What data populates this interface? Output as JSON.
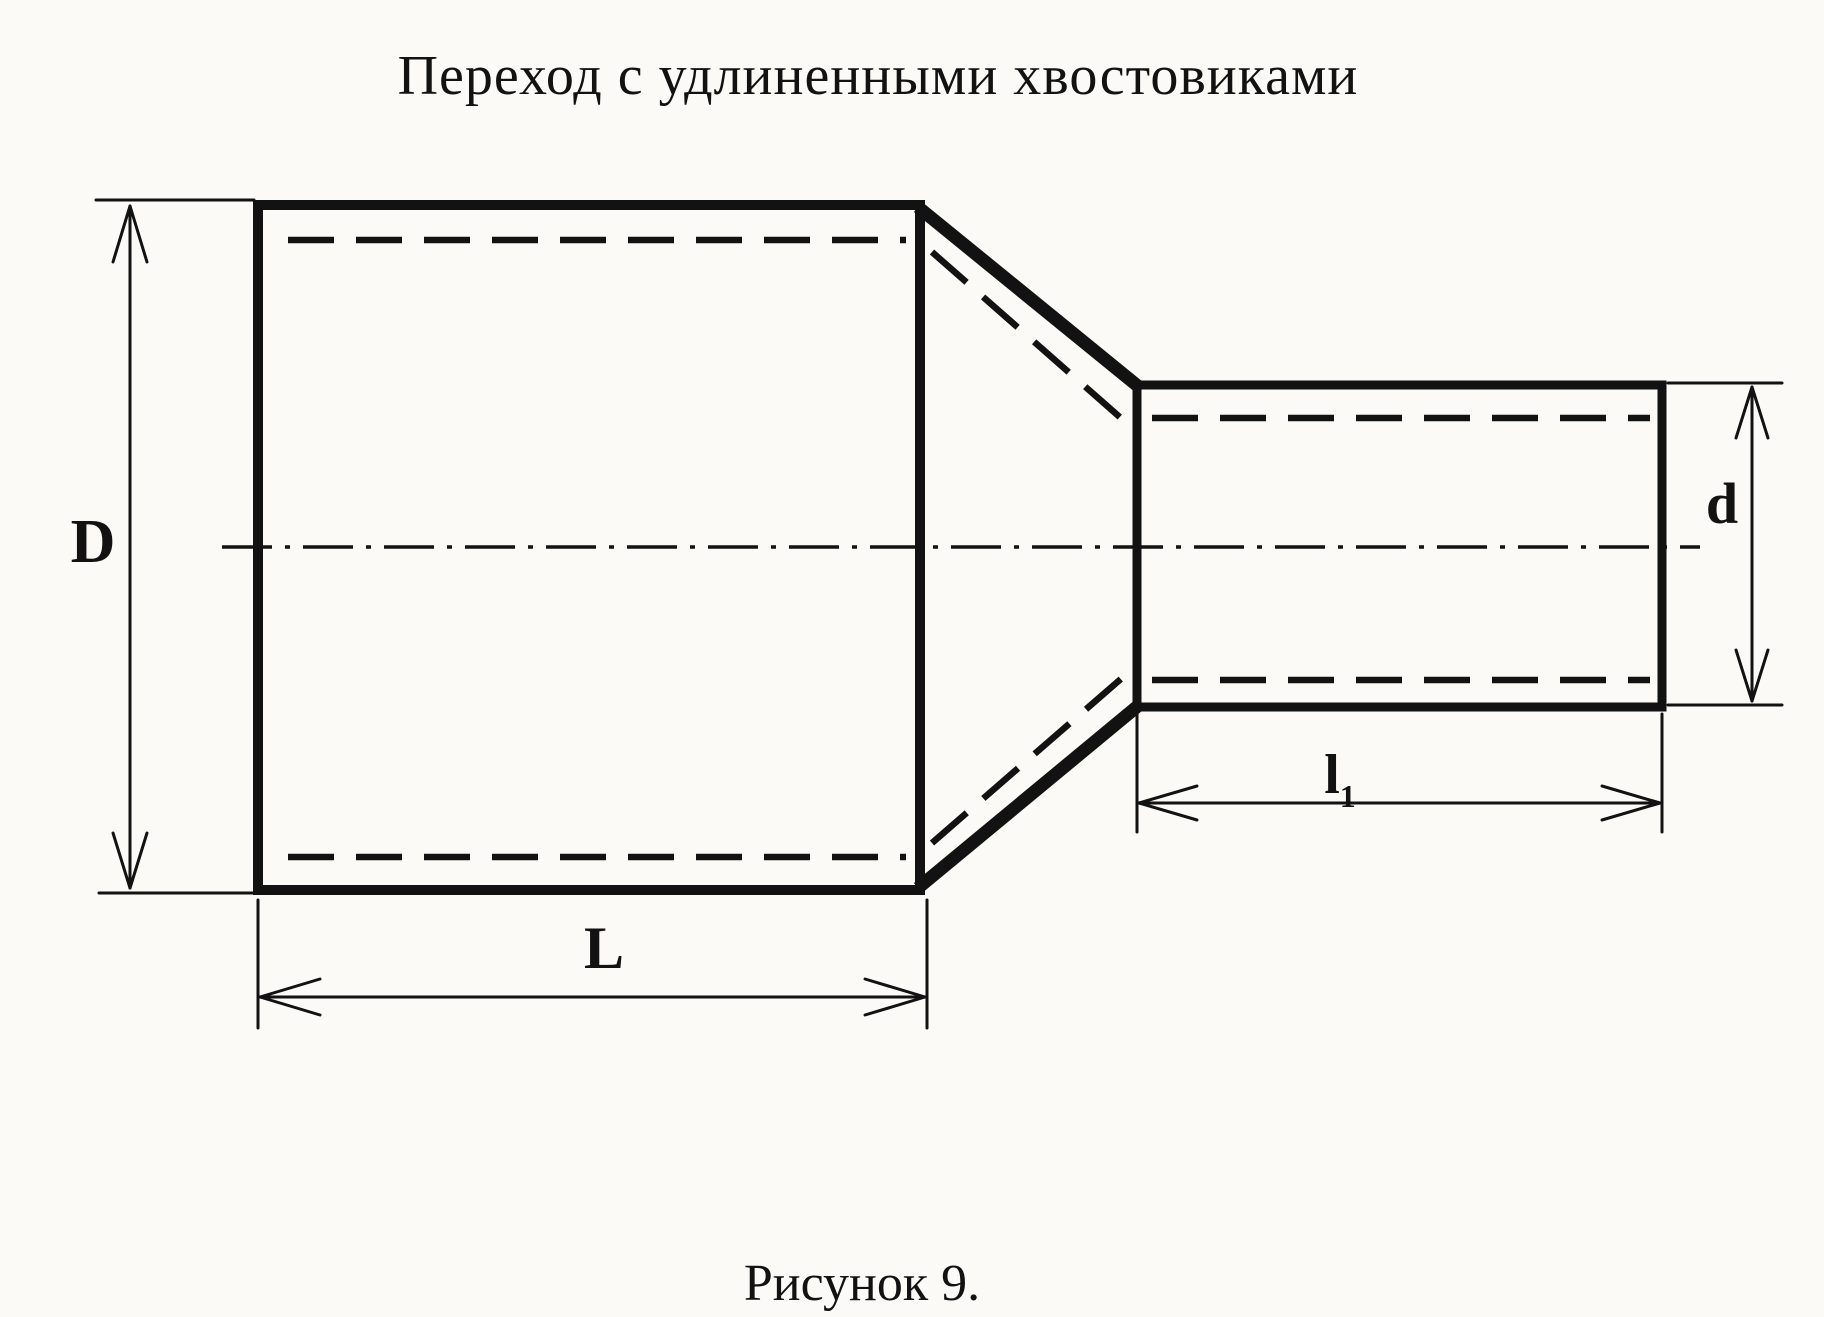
{
  "title": "Переход с удлиненными хвостовиками",
  "caption": "Рисунок 9.",
  "dimension_labels": {
    "large_diameter": "D",
    "small_diameter": "d",
    "large_length": "L",
    "tail_length_base": "l",
    "tail_length_sub": "1"
  },
  "colors": {
    "ink": "#121212",
    "paper": "#fbfaf7"
  }
}
